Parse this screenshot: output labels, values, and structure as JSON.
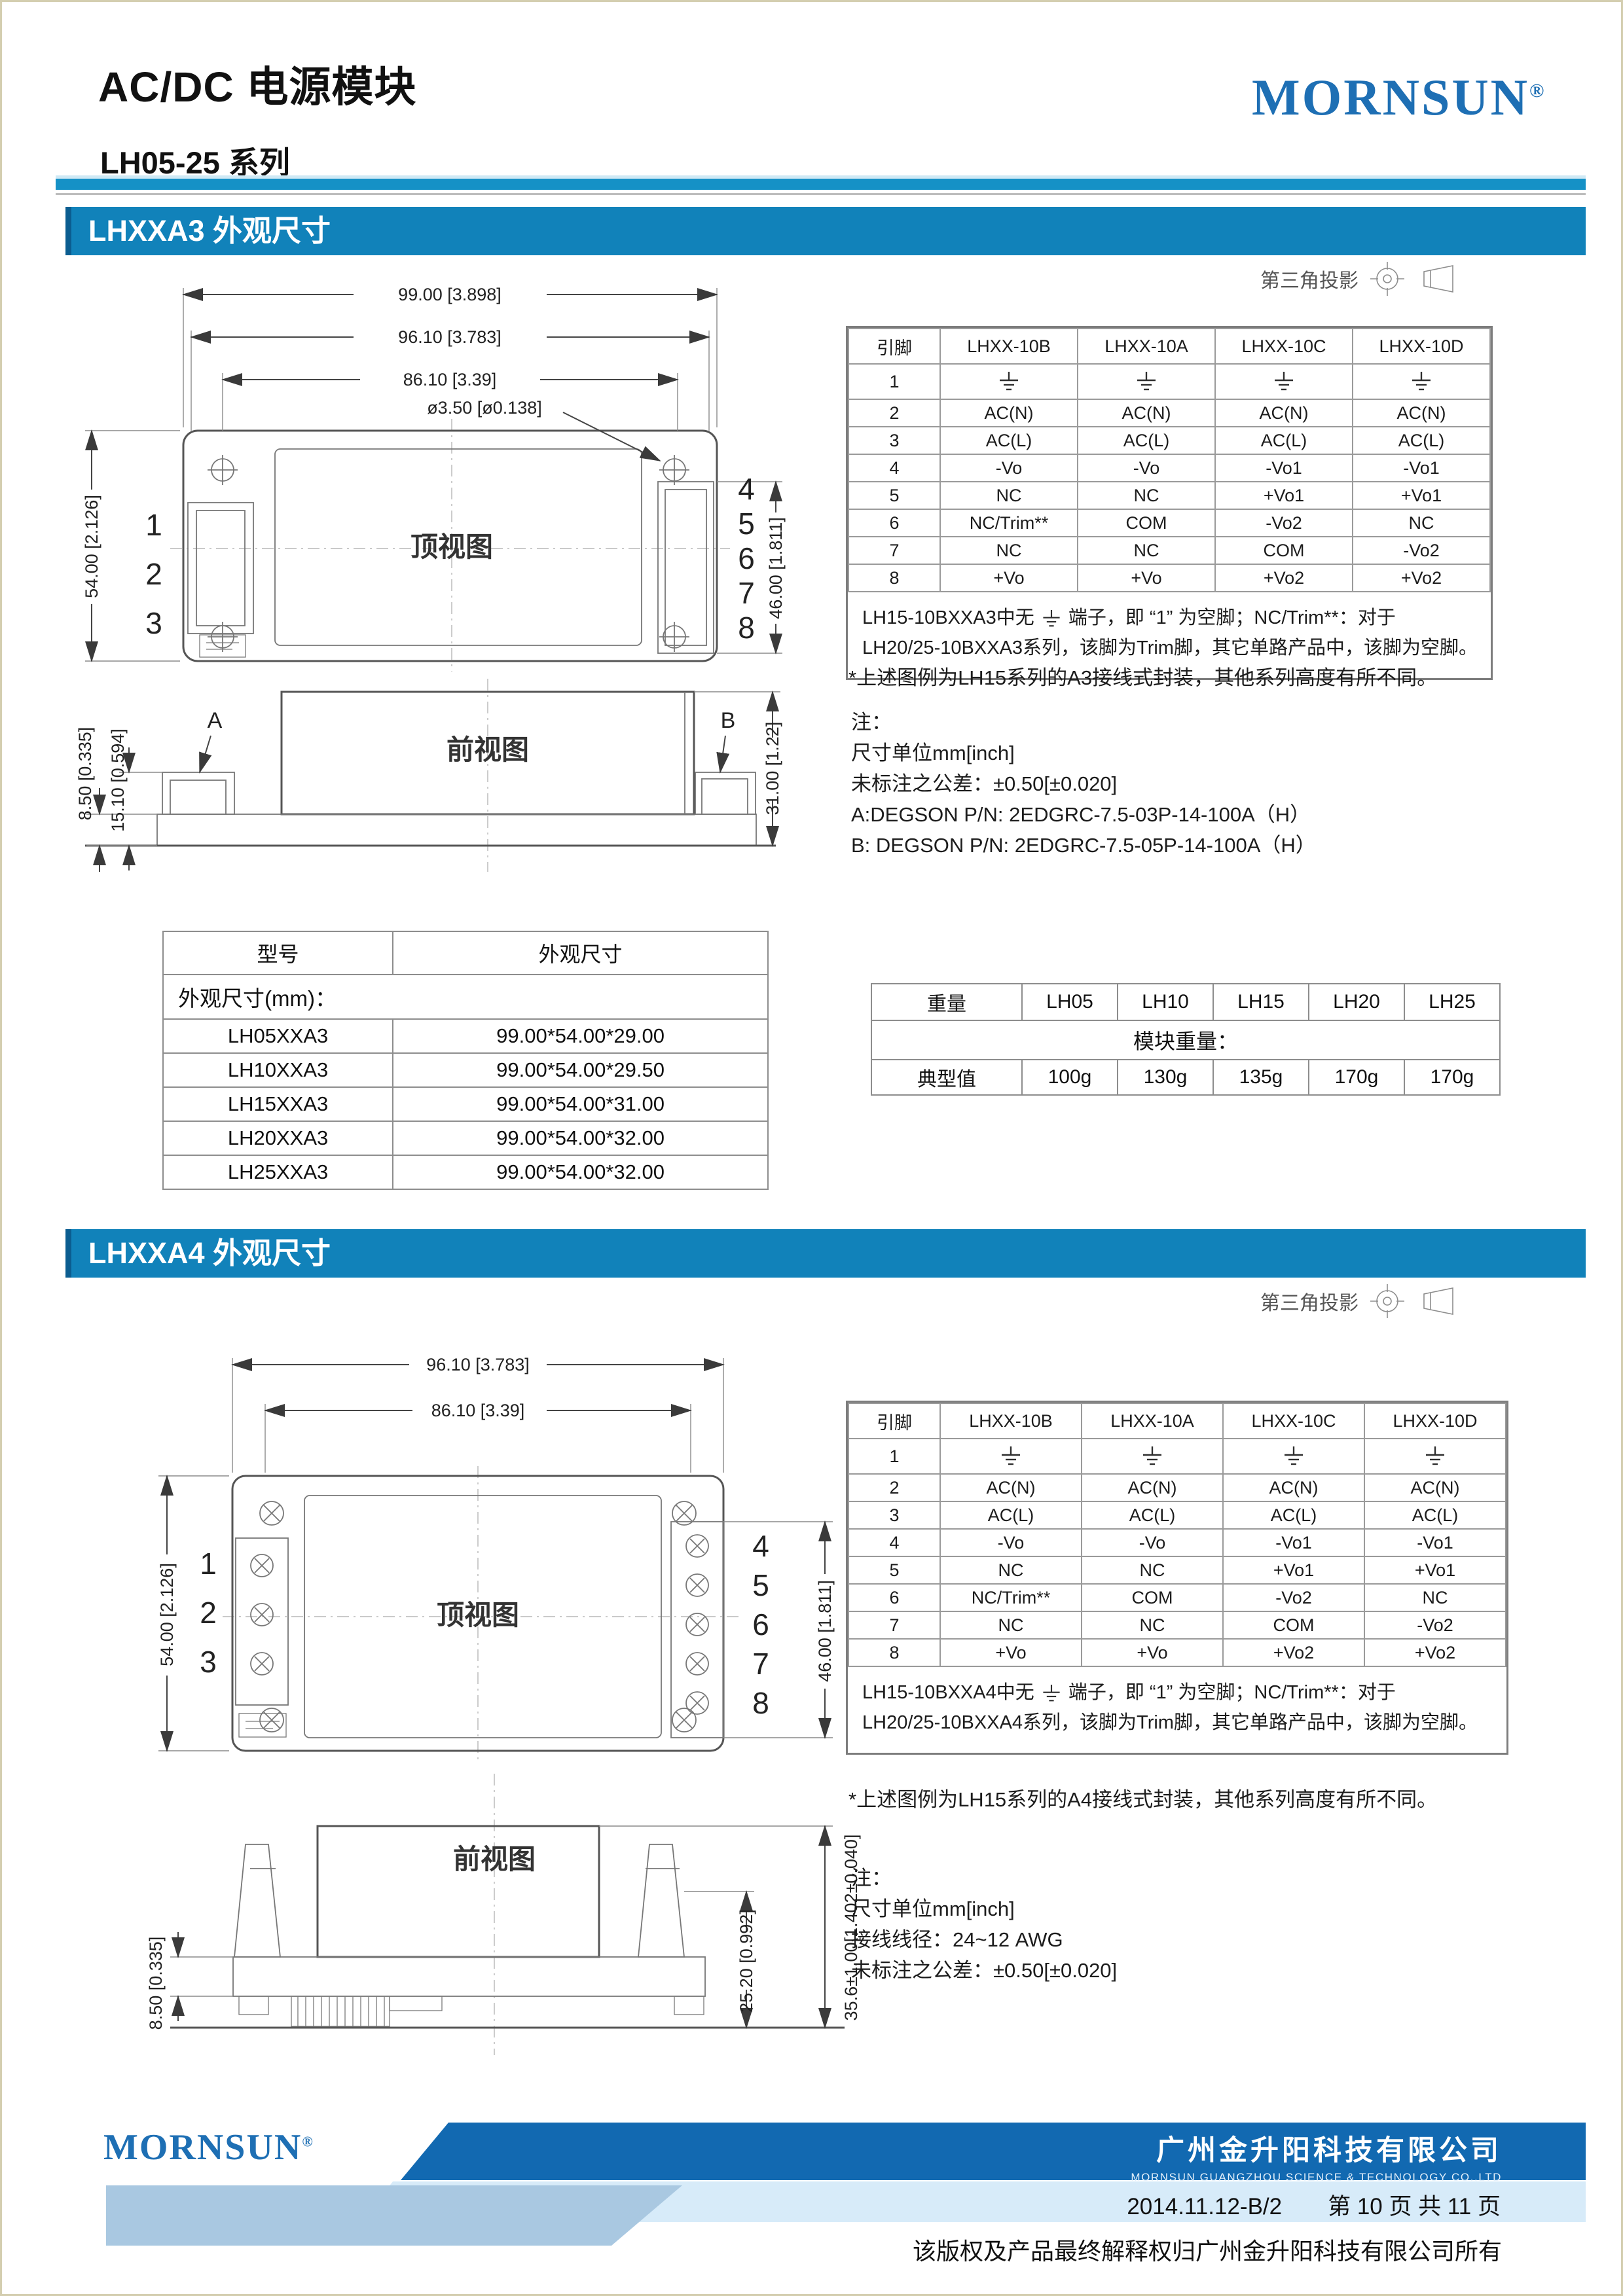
{
  "header": {
    "title": "AC/DC 电源模块",
    "subtitle": "LH05-25 系列",
    "brand": "MORNSUN",
    "brand_reg": "®"
  },
  "projection_label": "第三角投影",
  "colors": {
    "accent_band": "#1182ba",
    "rule_blue": "#1591c6",
    "logo_blue": "#1e6fb4",
    "footer_dark": "#1269b1",
    "footer_light": "#d7ebf9",
    "footer_mid": "#a9c8e1"
  },
  "section_a3": {
    "heading": "LHXXA3 外观尺寸",
    "top_view": {
      "label": "顶视图",
      "dim_99": "99.00 [3.898]",
      "dim_96": "96.10 [3.783]",
      "dim_86": "86.10 [3.39]",
      "dim_hole": "ø3.50 [ø0.138]",
      "dim_54": "54.00 [2.126]",
      "dim_46": "46.00 [1.811]",
      "pins_left": [
        "1",
        "2",
        "3"
      ],
      "pins_right": [
        "4",
        "5",
        "6",
        "7",
        "8"
      ]
    },
    "front_view": {
      "label": "前视图",
      "dim_850": "8.50 [0.335]",
      "dim_1510": "15.10 [0.594]",
      "dim_3100": "31.00 [1.22]",
      "label_a": "A",
      "label_b": "B"
    },
    "pin_table": {
      "headers": [
        "引脚",
        "LHXX-10B",
        "LHXX-10A",
        "LHXX-10C",
        "LHXX-10D"
      ],
      "rows": [
        [
          "1",
          "⏚",
          "⏚",
          "⏚",
          "⏚"
        ],
        [
          "2",
          "AC(N)",
          "AC(N)",
          "AC(N)",
          "AC(N)"
        ],
        [
          "3",
          "AC(L)",
          "AC(L)",
          "AC(L)",
          "AC(L)"
        ],
        [
          "4",
          "-Vo",
          "-Vo",
          "-Vo1",
          "-Vo1"
        ],
        [
          "5",
          "NC",
          "NC",
          "+Vo1",
          "+Vo1"
        ],
        [
          "6",
          "NC/Trim**",
          "COM",
          "-Vo2",
          "NC"
        ],
        [
          "7",
          "NC",
          "NC",
          "COM",
          "-Vo2"
        ],
        [
          "8",
          "+Vo",
          "+Vo",
          "+Vo2",
          "+Vo2"
        ]
      ],
      "note_pre": "LH15-10BXXA3中无",
      "note_post": "端子，即 “1” 为空脚；NC/Trim**：对于",
      "note_line2": "LH20/25-10BXXA3系列，该脚为Trim脚，其它单路产品中，该脚为空脚。"
    },
    "figure_note": "*上述图例为LH15系列的A3接线式封装，其他系列高度有所不同。",
    "notes": [
      "注：",
      "尺寸单位mm[inch]",
      "未标注之公差：±0.50[±0.020]",
      "A:DEGSON P/N: 2EDGRC-7.5-03P-14-100A（H）",
      "B: DEGSON P/N: 2EDGRC-7.5-05P-14-100A（H）"
    ],
    "dim_table": {
      "title": "外观尺寸(mm)：",
      "headers": [
        "型号",
        "外观尺寸"
      ],
      "rows": [
        [
          "LH05XXA3",
          "99.00*54.00*29.00"
        ],
        [
          "LH10XXA3",
          "99.00*54.00*29.50"
        ],
        [
          "LH15XXA3",
          "99.00*54.00*31.00"
        ],
        [
          "LH20XXA3",
          "99.00*54.00*32.00"
        ],
        [
          "LH25XXA3",
          "99.00*54.00*32.00"
        ]
      ]
    },
    "weight_table": {
      "title": "模块重量：",
      "headers": [
        "重量",
        "LH05",
        "LH10",
        "LH15",
        "LH20",
        "LH25"
      ],
      "rows": [
        [
          "典型值",
          "100g",
          "130g",
          "135g",
          "170g",
          "170g"
        ]
      ]
    }
  },
  "section_a4": {
    "heading": "LHXXA4 外观尺寸",
    "top_view": {
      "label": "顶视图",
      "dim_96": "96.10 [3.783]",
      "dim_86": "86.10 [3.39]",
      "dim_54": "54.00 [2.126]",
      "dim_46": "46.00 [1.811]",
      "pins_left": [
        "1",
        "2",
        "3"
      ],
      "pins_right": [
        "4",
        "5",
        "6",
        "7",
        "8"
      ]
    },
    "front_view": {
      "label": "前视图",
      "dim_850": "8.50 [0.335]",
      "dim_2520": "25.20 [0.992]",
      "dim_356": "35.6±1.00[1.402±0.040]"
    },
    "pin_table": {
      "headers": [
        "引脚",
        "LHXX-10B",
        "LHXX-10A",
        "LHXX-10C",
        "LHXX-10D"
      ],
      "rows": [
        [
          "1",
          "⏚",
          "⏚",
          "⏚",
          "⏚"
        ],
        [
          "2",
          "AC(N)",
          "AC(N)",
          "AC(N)",
          "AC(N)"
        ],
        [
          "3",
          "AC(L)",
          "AC(L)",
          "AC(L)",
          "AC(L)"
        ],
        [
          "4",
          "-Vo",
          "-Vo",
          "-Vo1",
          "-Vo1"
        ],
        [
          "5",
          "NC",
          "NC",
          "+Vo1",
          "+Vo1"
        ],
        [
          "6",
          "NC/Trim**",
          "COM",
          "-Vo2",
          "NC"
        ],
        [
          "7",
          "NC",
          "NC",
          "COM",
          "-Vo2"
        ],
        [
          "8",
          "+Vo",
          "+Vo",
          "+Vo2",
          "+Vo2"
        ]
      ],
      "note_pre": "LH15-10BXXA4中无",
      "note_post": "端子，即 “1” 为空脚；NC/Trim**：对于",
      "note_line2": "LH20/25-10BXXA4系列，该脚为Trim脚，其它单路产品中，该脚为空脚。"
    },
    "figure_note": "*上述图例为LH15系列的A4接线式封装，其他系列高度有所不同。",
    "notes": [
      "注：",
      "尺寸单位mm[inch]",
      "接线线径：24~12 AWG",
      "未标注之公差：±0.50[±0.020]"
    ]
  },
  "footer": {
    "logo": "MORNSUN",
    "logo_reg": "®",
    "company_cn": "广州金升阳科技有限公司",
    "company_en": "MORNSUN GUANGZHOU SCIENCE & TECHNOLOGY CO.,LTD",
    "date_code": "2014.11.12-B/2",
    "page_info": "第 10 页 共 11 页",
    "copyright": "该版权及产品最终解释权归广州金升阳科技有限公司所有"
  }
}
